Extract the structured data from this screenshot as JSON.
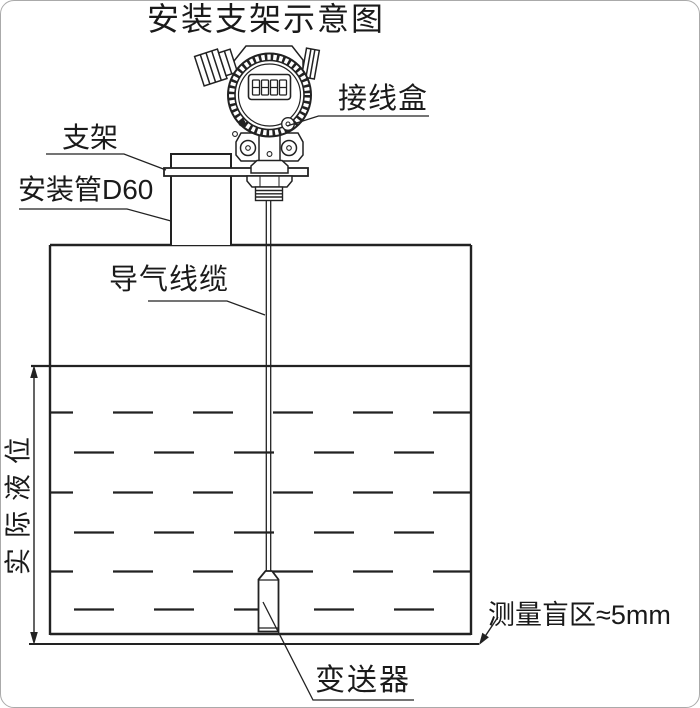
{
  "title": "安装支架示意图",
  "labels": {
    "junction_box": "接线盒",
    "bracket": "支架",
    "mounting_pipe": "安装管D60",
    "air_cable": "导气线缆",
    "actual_level": "实际液位",
    "blind_zone": "测量盲区≈5mm",
    "transmitter": "变送器"
  },
  "display": {
    "value": "8888"
  },
  "colors": {
    "line": "#222222",
    "background": "#ffffff",
    "border": "#aaaaaa"
  }
}
